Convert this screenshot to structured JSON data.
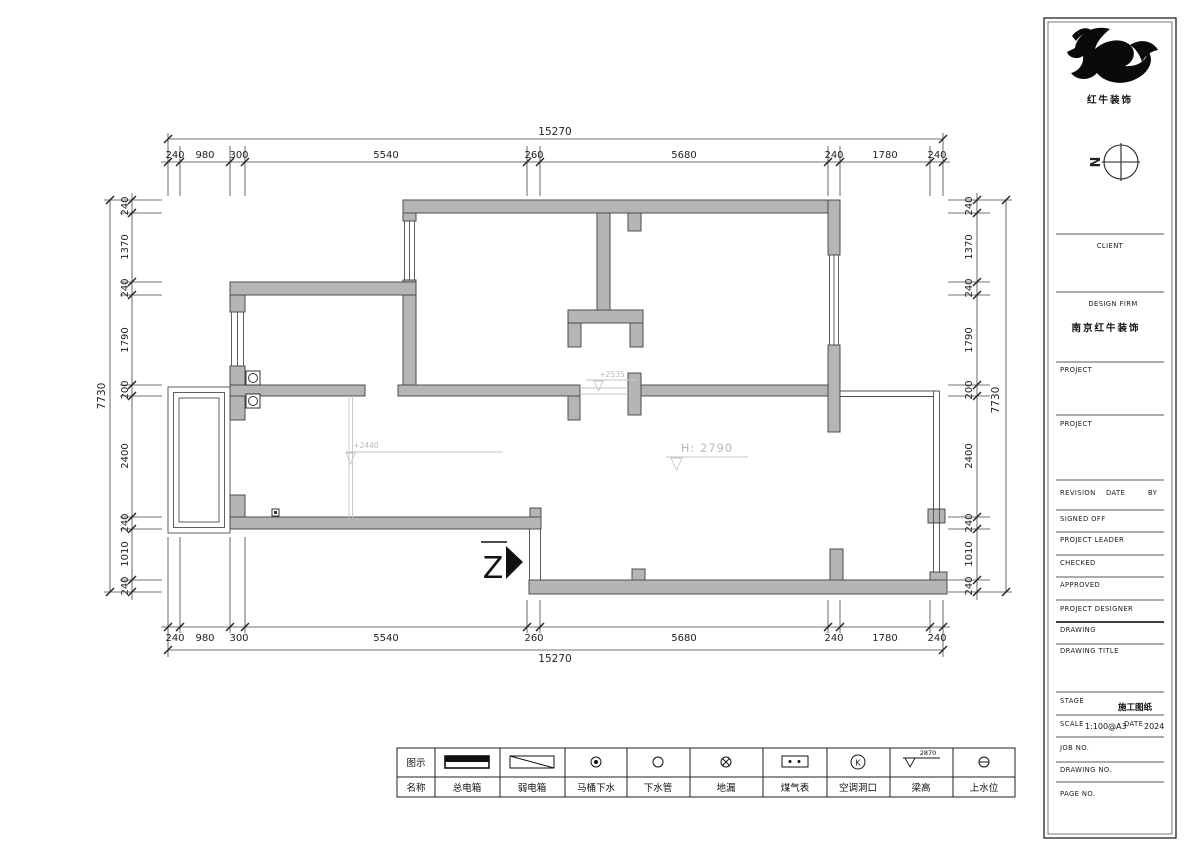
{
  "brand": {
    "name": "红牛装饰",
    "compass_letter": "N"
  },
  "dims": {
    "top": {
      "overall": "15270",
      "chain": [
        "240",
        "980",
        "300",
        "5540",
        "260",
        "5680",
        "240",
        "1780",
        "240"
      ]
    },
    "bottom": {
      "overall": "15270",
      "chain": [
        "240",
        "980",
        "300",
        "5540",
        "260",
        "5680",
        "240",
        "1780",
        "240"
      ]
    },
    "left": {
      "overall": "7730",
      "chain": [
        "240",
        "1370",
        "240",
        "1790",
        "200",
        "2400",
        "240",
        "1010",
        "240"
      ]
    },
    "right": {
      "overall": "7730",
      "chain": [
        "240",
        "1370",
        "240",
        "1790",
        "200",
        "2400",
        "240",
        "1010",
        "240"
      ]
    }
  },
  "plan": {
    "annotations": {
      "level_a": "+2535",
      "level_b": "+2440",
      "ceiling_height": "H: 2790"
    },
    "entry_letter": "Z"
  },
  "title_block": {
    "client_label": "CLIENT",
    "design_firm_label": "DESIGN FIRM",
    "design_firm_value": "南京红牛装饰",
    "project1_label": "PROJECT",
    "project2_label": "PROJECT",
    "revision_label": "REVISION",
    "date_label": "DATE",
    "by_label": "BY",
    "signed_off_label": "SIGNED OFF",
    "project_leader_label": "PROJECT LEADER",
    "checked_label": "CHECKED",
    "approved_label": "APPROVED",
    "project_designer_label": "PROJECT DESIGNER",
    "drawing_label": "DRAWING",
    "drawing_title_label": "DRAWING TITLE",
    "stage_label": "STAGE",
    "stage_value": "施工图纸",
    "scale_label": "SCALE",
    "scale_value": "1:100@A3",
    "date2_label": "DATE",
    "date_value": "2024",
    "job_no_label": "JOB NO.",
    "drawing_no_label": "DRAWING NO.",
    "page_no_label": "PAGE NO."
  },
  "legend": {
    "header_symbol": "图示",
    "header_name": "名称",
    "items": [
      {
        "name": "总电箱"
      },
      {
        "name": "弱电箱"
      },
      {
        "name": "马桶下水"
      },
      {
        "name": "下水管"
      },
      {
        "name": "地漏"
      },
      {
        "name": "煤气表"
      },
      {
        "name": "空调洞口"
      },
      {
        "name": "梁高",
        "value": "2870"
      },
      {
        "name": "上水位"
      }
    ]
  }
}
